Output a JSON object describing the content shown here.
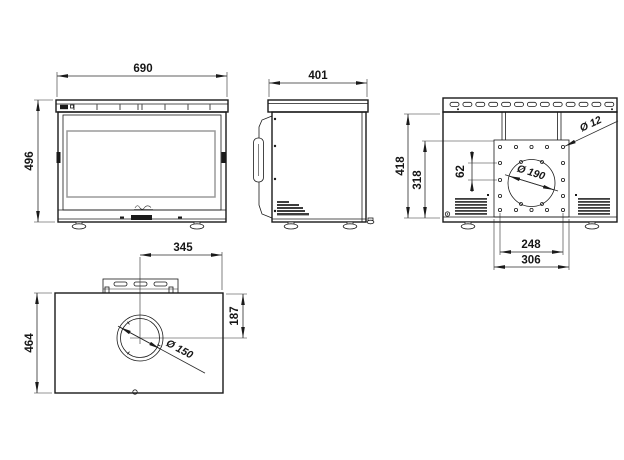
{
  "front_view": {
    "width_label": "690",
    "height_label": "496"
  },
  "side_view": {
    "depth_label": "401"
  },
  "back_view": {
    "height_label": "418",
    "plate_height_label": "318",
    "hole_pitch_label": "62",
    "flue_hole_label": "Ø 190",
    "bolt_hole_label": "Ø 12",
    "bolt_pitch_label": "248",
    "plate_width_label": "306"
  },
  "top_view": {
    "side_offset_label": "345",
    "depth_label": "464",
    "front_offset_label": "187",
    "flue_label": "Ø 150"
  }
}
